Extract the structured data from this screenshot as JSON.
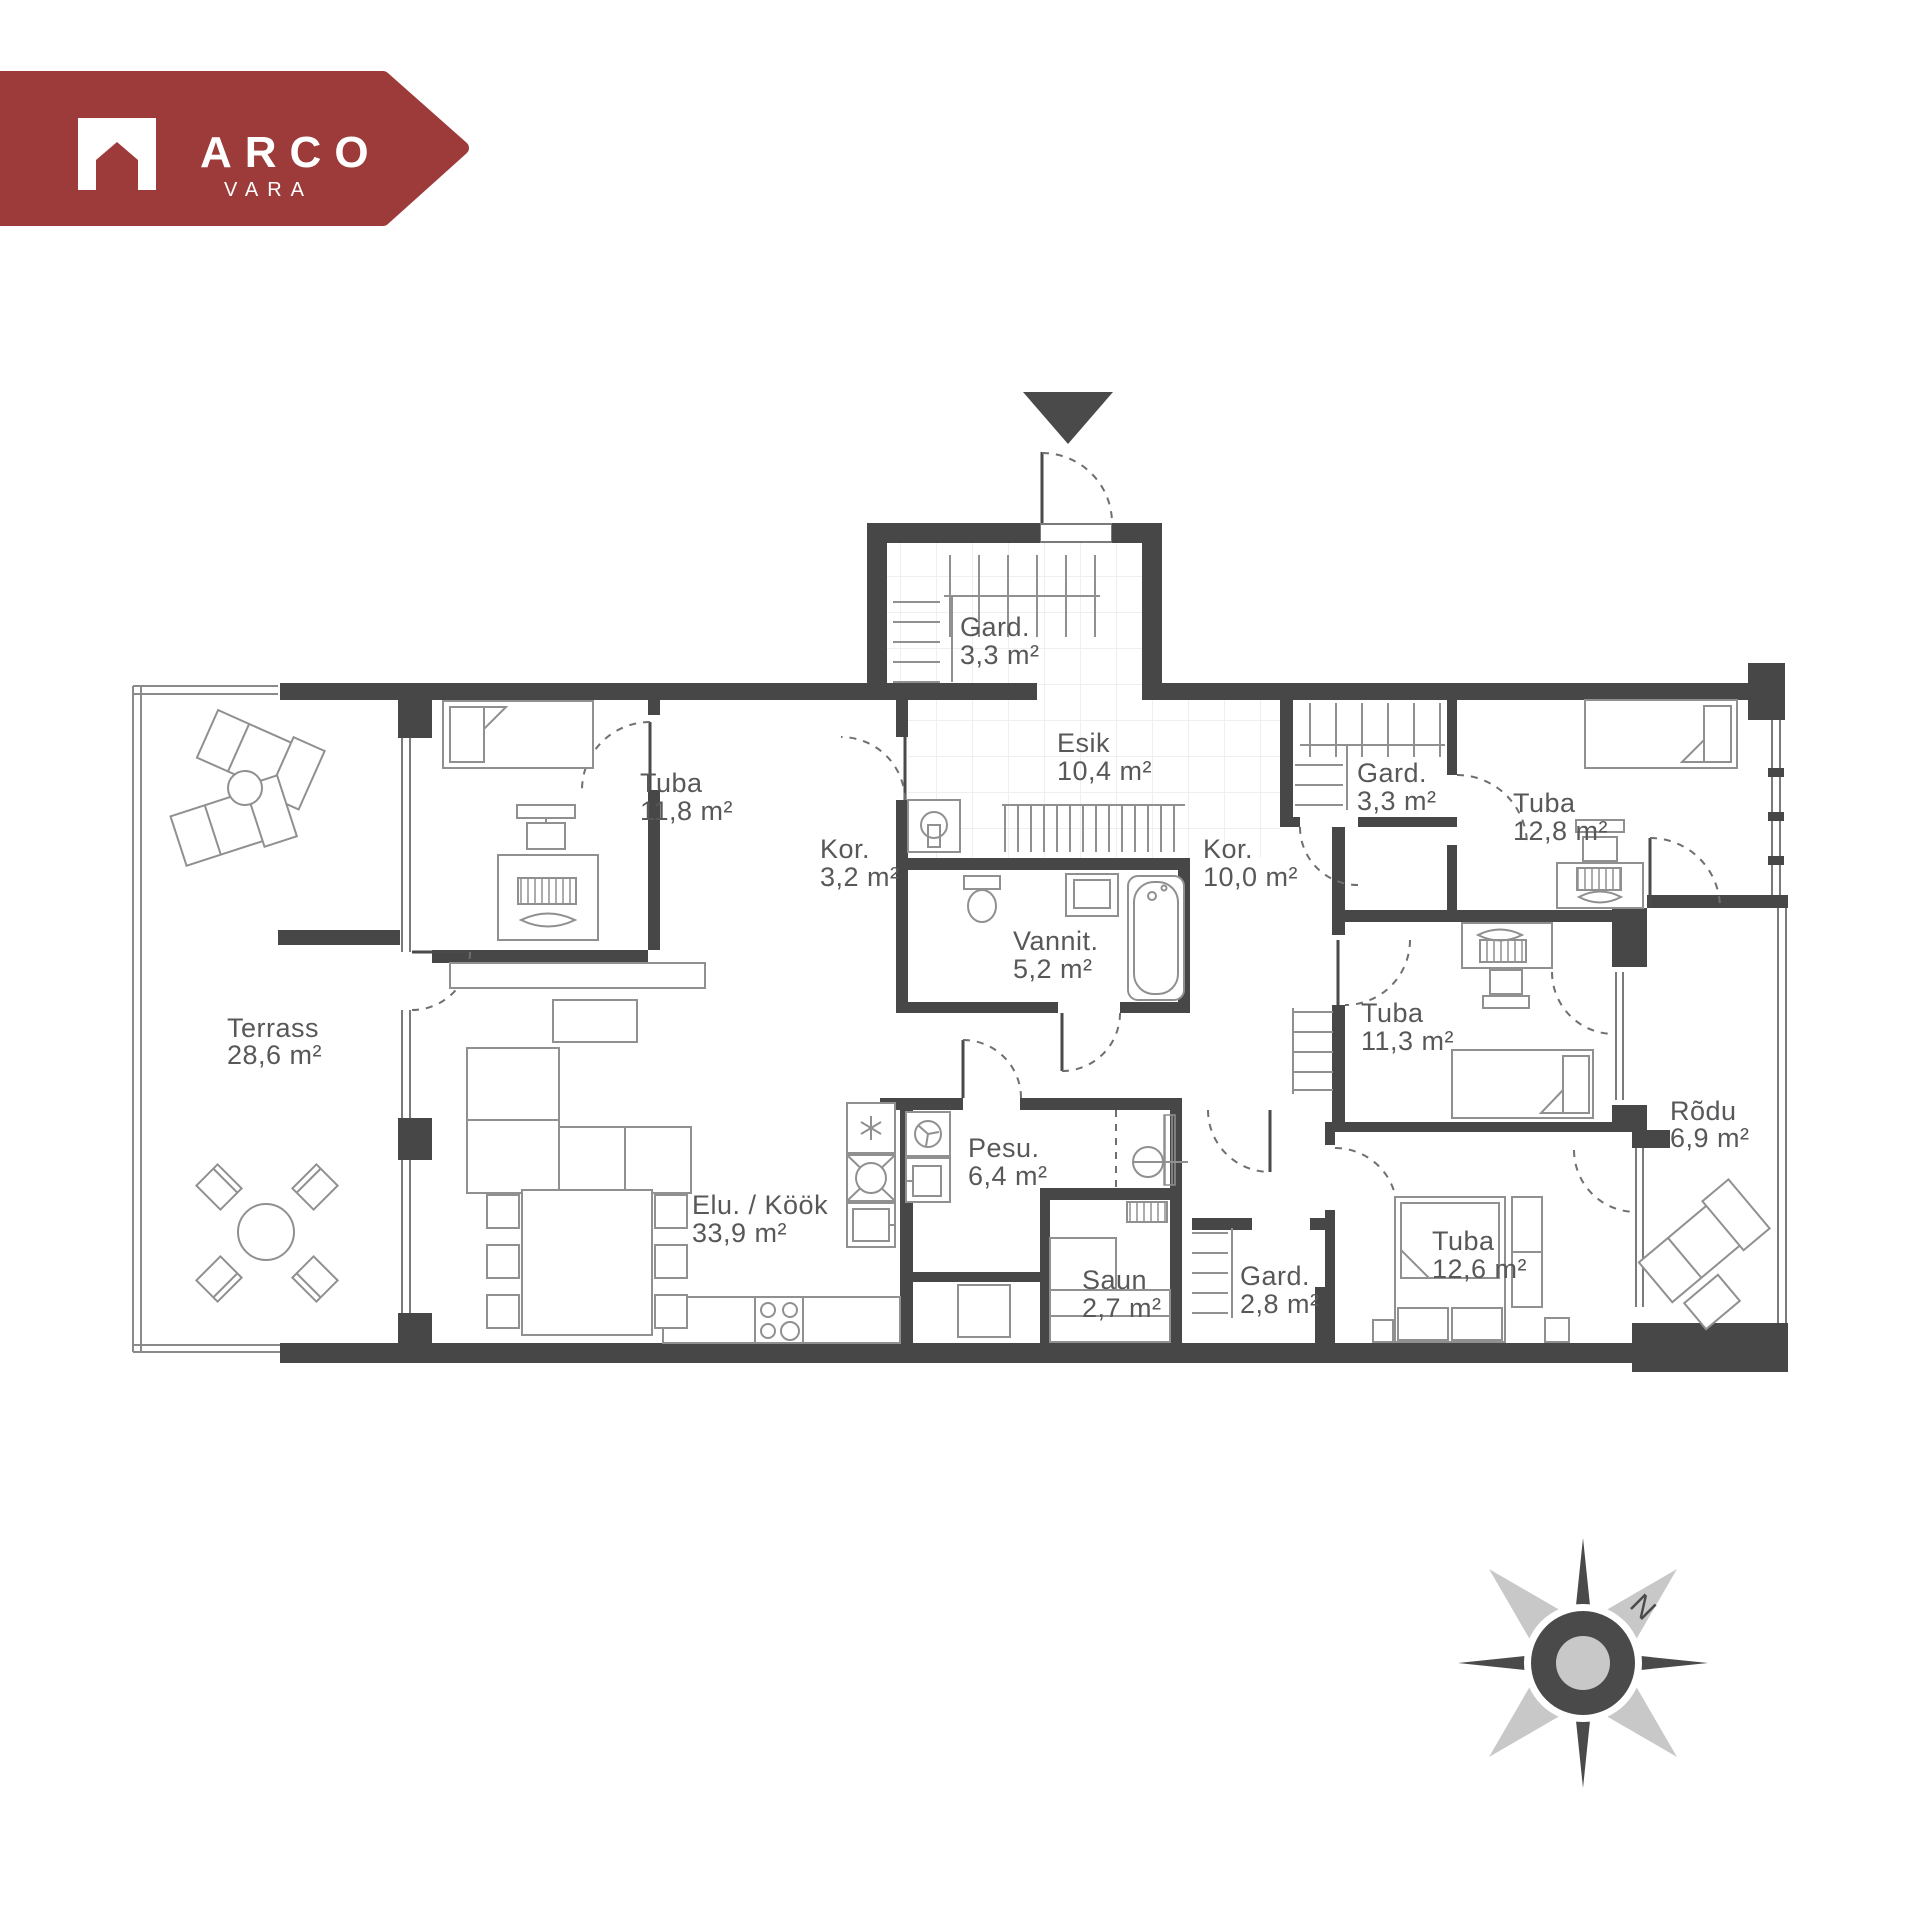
{
  "logo": {
    "brand": "ARCO",
    "sub": "VARA",
    "color": "#9d3b3b"
  },
  "compass": {
    "north_label": "N"
  },
  "plan": {
    "rooms": {
      "gard_entry": {
        "name": "Gard.",
        "area": "3,3 m²"
      },
      "esik": {
        "name": "Esik",
        "area": "10,4 m²"
      },
      "kor_small": {
        "name": "Kor.",
        "area": "3,2 m²"
      },
      "kor_main": {
        "name": "Kor.",
        "area": "10,0 m²"
      },
      "gard_right": {
        "name": "Gard.",
        "area": "3,3 m²"
      },
      "tuba_ne": {
        "name": "Tuba",
        "area": "12,8 m²"
      },
      "tuba_nw": {
        "name": "Tuba",
        "area": "11,8 m²"
      },
      "vannituba": {
        "name": "Vannit.",
        "area": "5,2 m²"
      },
      "terrass": {
        "name": "Terrass",
        "area": "28,6 m²"
      },
      "tuba_e": {
        "name": "Tuba",
        "area": "11,3 m²"
      },
      "rodu": {
        "name": "Rõdu",
        "area": "6,9 m²"
      },
      "elukook": {
        "name": "Elu. / Köök",
        "area": "33,9 m²"
      },
      "pesu": {
        "name": "Pesu.",
        "area": "6,4 m²"
      },
      "saun": {
        "name": "Saun",
        "area": "2,7 m²"
      },
      "gard_s": {
        "name": "Gard.",
        "area": "2,8 m²"
      },
      "tuba_se": {
        "name": "Tuba",
        "area": "12,6 m²"
      }
    },
    "colors": {
      "wall": "#474747",
      "furniture_line": "#909090",
      "label_text": "#57585a",
      "logo_red": "#9d3b3b",
      "compass_light": "#c8c8c8",
      "compass_dark": "#4a4a4a"
    }
  }
}
